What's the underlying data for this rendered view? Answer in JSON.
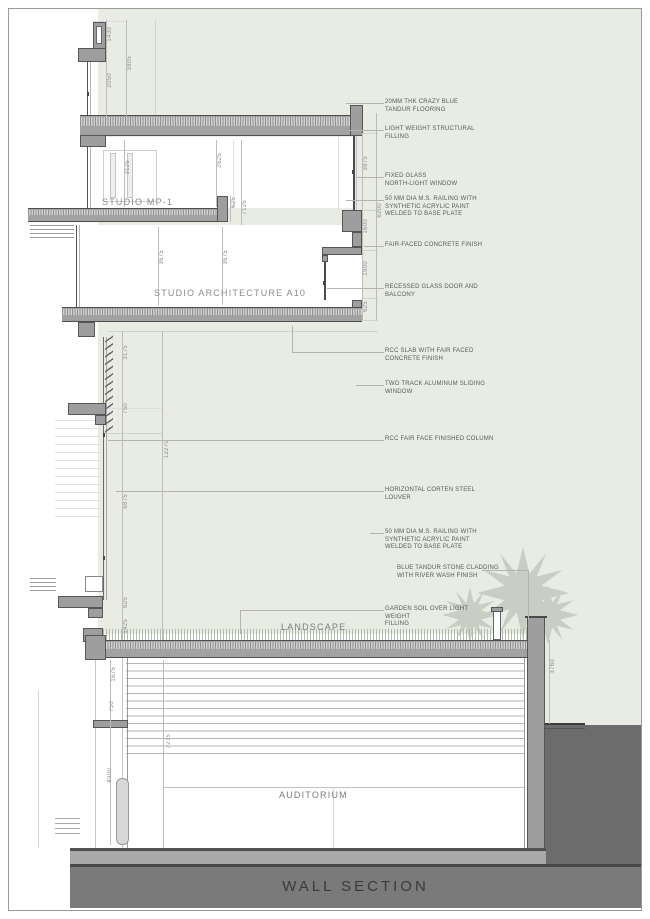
{
  "sheet": {
    "title": "WALL SECTION"
  },
  "rooms": {
    "studio_mp1": "STUDIO MP-1",
    "studio_a10": "STUDIO ARCHITECTURE A10",
    "landscape": "LANDSCAPE",
    "auditorium": "AUDITORIUM"
  },
  "annotations": {
    "a1": "20MM THK CRAZY BLUE\nTANDUR FLOORING",
    "a2": "LIGHT WEIGHT STRUCTURAL\nFILLING",
    "a3": "FIXED GLASS\nNORTH-LIGHT WINDOW",
    "a4": "50 MM DIA M.S. RAILING WITH\nSYNTHETIC ACRYLIC PAINT\nWELDED TO BASE PLATE",
    "a5": "FAIR-FACED CONCRETE FINISH",
    "a6": "RECESSED GLASS DOOR AND\nBALCONY",
    "a7": "RCC SLAB WITH FAIR FACED\nCONCRETE FINISH",
    "a8": "TWO TRACK ALUMINUM SLIDING\nWINDOW",
    "a9": "RCC FAIR FACE FINISHED COLUMN",
    "a10": "HORIZONTAL CORTEN STEEL\nLOUVER",
    "a11": "50 MM DIA M.S. RAILING WITH\nSYNTHETIC ACRYLIC PAINT\nWELDED TO BASE PLATE",
    "a12": "BLUE TANDUR STONE CLADDING\nWITH RIVER WASH FINISH",
    "a13": "GARDEN SOIL OVER LIGHT WEIGHT\nFILLING"
  },
  "dimensions": {
    "d1": "1430",
    "d2": "3805",
    "d3": "2050",
    "d4": "3125",
    "d5": "2625",
    "d6": "625",
    "d7": "7125",
    "d8": "3675",
    "d9": "3675",
    "d10": "3875",
    "d11": "6200",
    "d12": "1600",
    "d13": "1900",
    "d14": "625",
    "d15": "3175",
    "d16": "750",
    "d17": "12270",
    "d18": "6875",
    "d19": "625",
    "d20": "1425",
    "d21": "1675",
    "d22": "750",
    "d23": "7275",
    "d24": "4900",
    "d25": "3760"
  },
  "colors": {
    "exterior_tint": "#e8ece3",
    "concrete": "#9e9e9e",
    "ground": "#6c6c6c",
    "title_band": "#7a7a7a",
    "plant": "#c8cec4"
  }
}
